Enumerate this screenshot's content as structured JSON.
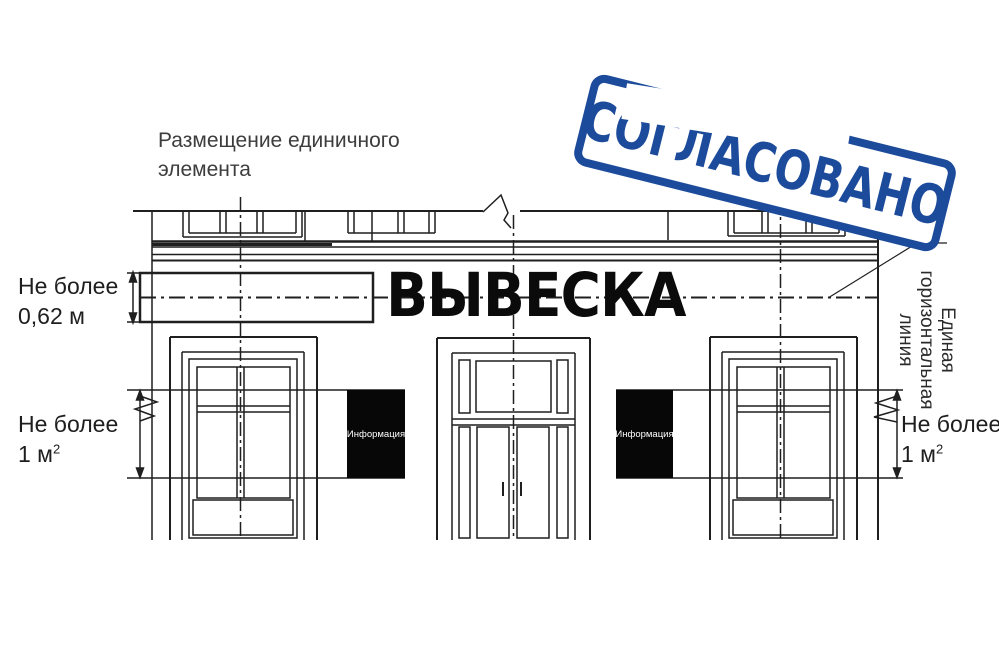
{
  "title": "Размещение единичного элемента",
  "stamp": {
    "text": "СОГЛАСОВАНО"
  },
  "sign_band": {
    "label": "ВЫВЕСКА"
  },
  "annotations": {
    "height_limit": "Не более 0,62 м",
    "left_area_limit": {
      "label": "Не более",
      "value": "1 м",
      "sup": "2"
    },
    "right_area_limit": {
      "label": "Не более",
      "value": "1 м",
      "sup": "2"
    },
    "horizontal_line_note": {
      "line1": "Единая",
      "line2": "горизонтальная",
      "line3": "линия"
    }
  },
  "info_boxes": {
    "left": "Информация",
    "right": "Информация"
  },
  "colors": {
    "stamp_blue": "#1d4b9b",
    "line_color": "#1f1f1f",
    "title_gray": "#3d3d3d"
  }
}
